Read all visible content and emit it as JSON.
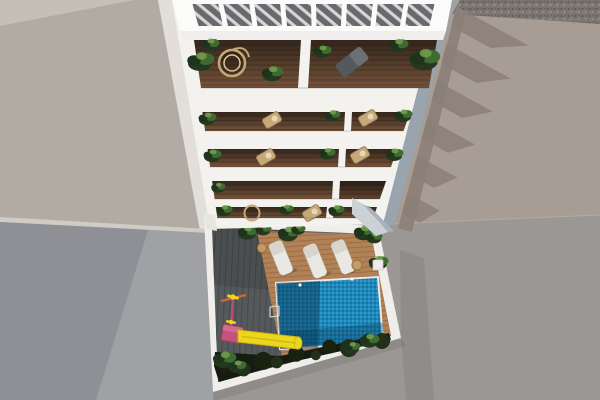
{
  "image": {
    "type": "architectural-3d-render",
    "description": "Aerial top-down render of a white multi-storey apartment building with a slatted rooftop pergola, stacked balconies holding plants and wicker furniture, and a ground-floor courtyard with a mosaic-tile swimming pool, wooden sun deck, three white loungers, a dark plank terrace, a children's slide in yellow and pink, and a dark green hedge."
  },
  "colors": {
    "white": "#f3f2ef",
    "whiteBright": "#fbfbfa",
    "facadeShade": "#efeeec",
    "wallWhite": "#f0eeeb",
    "leftRoof": "#b2aba3",
    "leftRoofLight": "#c8c1b7",
    "walkway": "#e2dfda",
    "parapet": "#cfccc5",
    "rightRoof": "#a89d94",
    "ground": "#9b9795",
    "gravel": "#7a7570",
    "wall": "#a0a1a5",
    "wallShadow": "#8e9095",
    "roofShadow": "#8b8078",
    "flank": "#9aa4ae",
    "pergolaFloor": "#6a6a6e",
    "pergolaStripe": "#e9e9ec",
    "woodTop": "#33261c",
    "woodBottom": "#75533a",
    "deckGray": "#56595b",
    "deckPlank": "#45484a",
    "woodDeck": "#b28257",
    "woodPlank": "#7a5130",
    "poolBase": "#1e86b8",
    "poolLight": "#2fa0d2",
    "poolMid": "#1a74a3",
    "poolShadow": "#0a3a55",
    "poolEdge": "#eceae6",
    "hedge": "#161c12",
    "plantDark": "#24381f",
    "plantDeep": "#1e331c",
    "plantMid": "#3f6b33",
    "plantLight": "#6f9c4a",
    "wicker": "#c7a878",
    "wickerLine": "#8d7048",
    "lounger": "#eae8e2",
    "loungerBack": "#d8d5ce",
    "table": "#c59a69",
    "tableRing": "#9b7446",
    "slideYellow": "#ecd71d",
    "slideEdge": "#c9b512",
    "platformPink": "#c2537a",
    "platformPinkDark": "#9c3c5e",
    "polePink": "#b44f74",
    "crossbarOrange": "#d4682f",
    "grayLounge": "#54595d",
    "grayLoungeLight": "#6a7074",
    "pillarLight": "#ccd1d5",
    "pillarDark": "#a9b2bb"
  },
  "scene": {
    "building": {
      "label": "white-apartment-building",
      "pergola_openings": 8,
      "balcony_rows": 5,
      "floor_material": "dark-wood",
      "furniture": [
        "hanging-wicker-chair",
        "gray-lounge-chair",
        "wicker-armchairs",
        "potted-plants"
      ]
    },
    "courtyard": {
      "sun_loungers": 3,
      "side_tables": 2,
      "pool": {
        "shape": "rectangle",
        "tile": "blue-mosaic",
        "lights": 2,
        "ladder": true
      },
      "playground": {
        "slide": true,
        "slide_color": "yellow",
        "tower_color": "pink"
      },
      "hedge": true,
      "deck_materials": [
        "dark-gray-planks",
        "warm-wood-planks"
      ]
    },
    "environment": {
      "left_surface": "neighbor-roof",
      "right_surface": "neighbor-roof",
      "gravel_strip_top_right": true,
      "balcony_shadow_teeth": 6,
      "lower_walls": "gray-courtyard-walls"
    }
  }
}
